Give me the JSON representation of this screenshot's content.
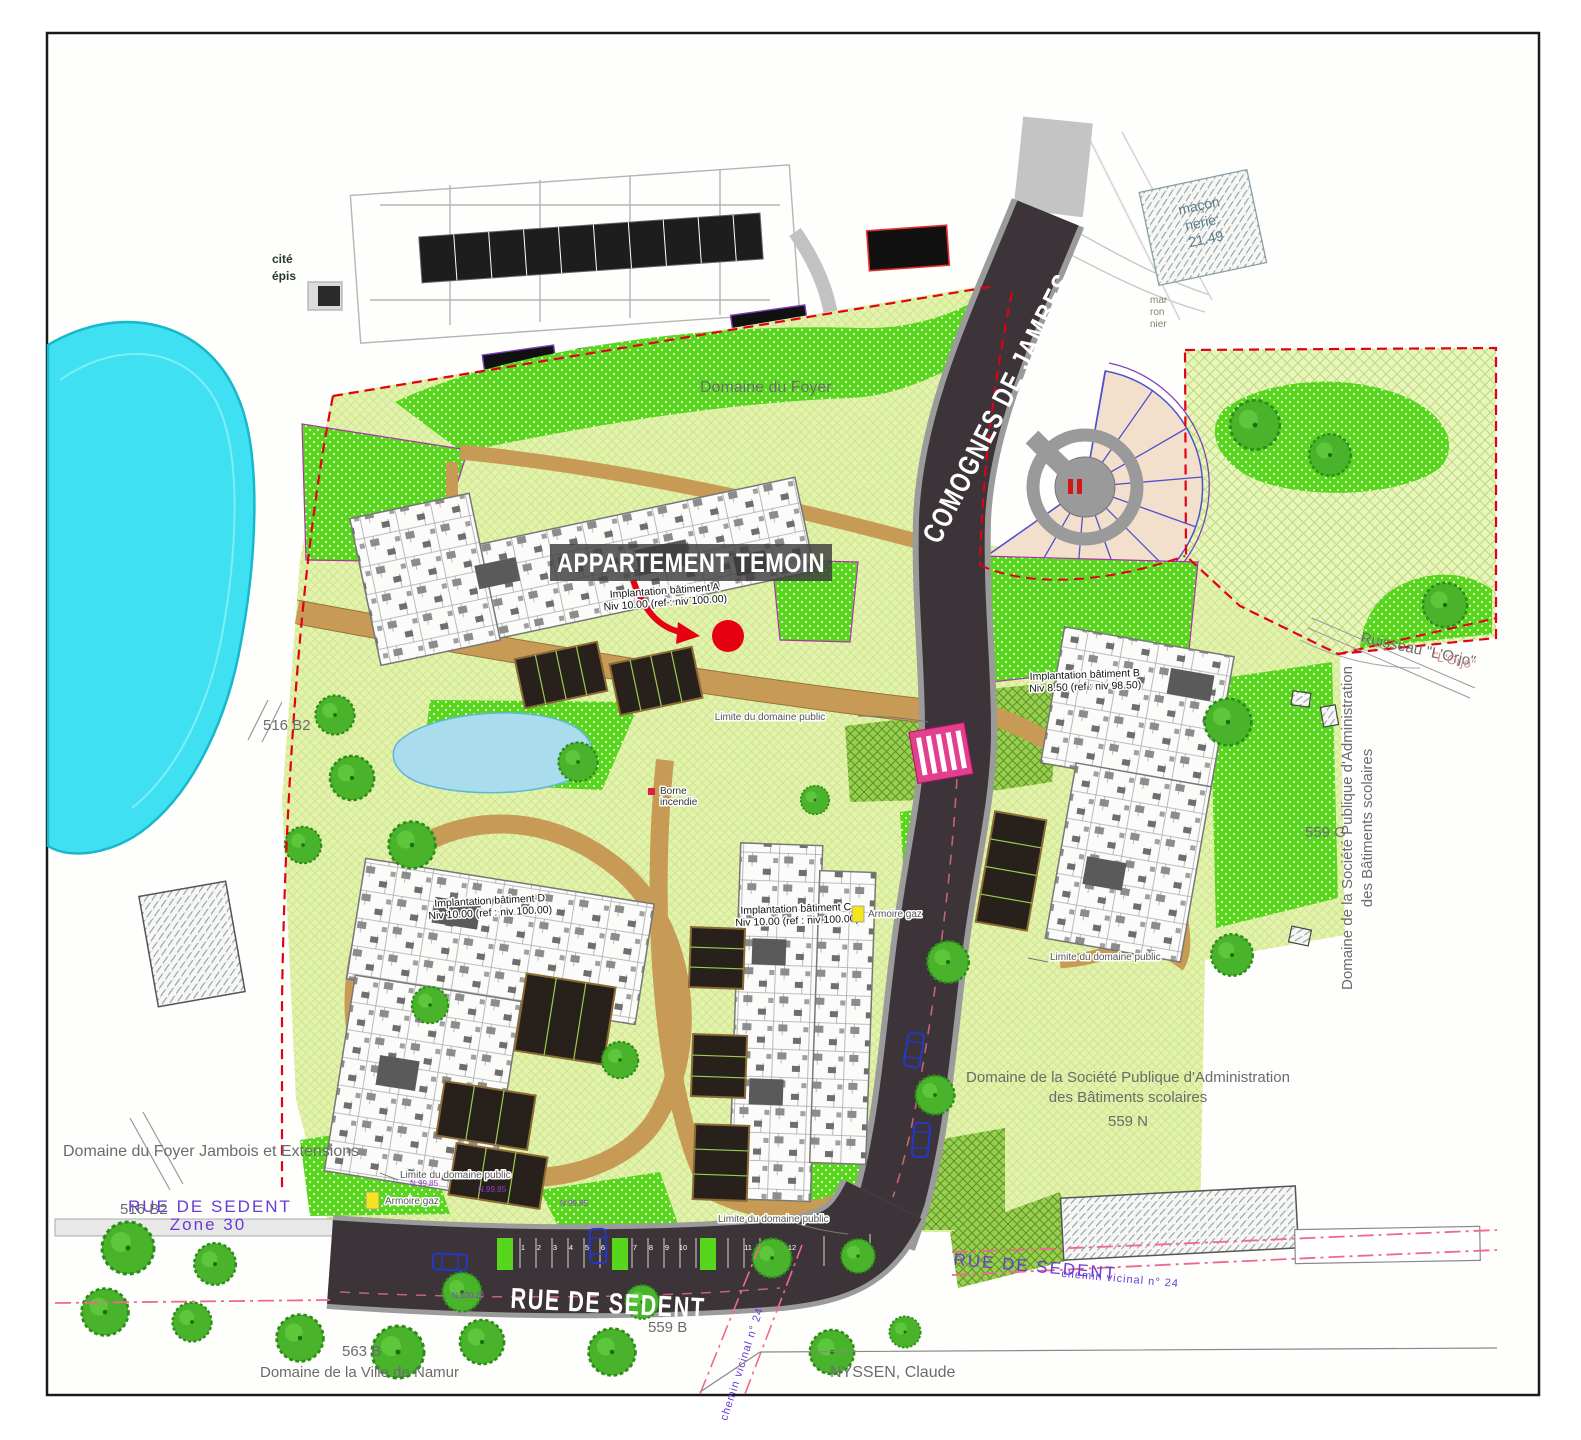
{
  "plan": {
    "callout": {
      "label": "APPARTEMENT TEMOIN"
    },
    "streets": {
      "comognes": "COMOGNES DE JAMBES",
      "rue_de_sedent": "RUE DE SEDENT",
      "rue_de_sedent_left": "RUE DE SEDENT",
      "zone": "Zone 30",
      "rue_de_sedent_right": "RUE DE SEDENT",
      "chemin_vicinal": "chemin vicinal n° 24",
      "chemin_vicinal_diag": "chemin vicinal n° 24"
    },
    "buildings": {
      "a_line1": "Implantation bâtiment A",
      "a_line2": "Niv 10.00 (ref : niv 100.00)",
      "b_line1": "Implantation bâtiment B",
      "b_line2": "Niv 8.50 (ref : niv 98.50)",
      "c_line1": "Implantation bâtiment C",
      "c_line2": "Niv 10.00 (ref : niv 100.00)",
      "d_line1": "Implantation bâtiment D",
      "d_line2": "Niv 10.00 (ref : niv 100.00)"
    },
    "parcels": {
      "left_516b2": "516 B2",
      "bottom_516b2": "516 B2",
      "g559": "559 G",
      "n559": "559 N",
      "b563": "563 B",
      "b559": "559 B"
    },
    "domains": {
      "foyer_top": "Domaine du Foyer",
      "foyer_left": "Domaine du Foyer Jambois et Extensions",
      "ville_namur": "Domaine de la Ville de Namur",
      "societe_line1": "Domaine de la Société Publique d'Administration",
      "societe_line2": "des Bâtiments scolaires",
      "nyssen": "NYSSEN, Claude"
    },
    "water": {
      "ruisseau": "Ruisseau \"L'Orjo\"",
      "ruisseau_ghost": "\"L'Orjo\""
    },
    "notes": {
      "limite": "Limite du domaine public",
      "borne_line1": "Borne",
      "borne_line2": "incendie",
      "armoire": "Armoire gaz",
      "maconnerie_line1": "maçon",
      "maconnerie_line2": "nerie:",
      "maconnerie_line3": "21.49",
      "cite_line1": "cité",
      "cite_line2": "épis",
      "marronnier_line1": "mar",
      "marronnier_line2": "ron",
      "marronnier_line3": "nier"
    },
    "levels": {
      "l1": "N.99.85",
      "l2": "N.99.85",
      "l3": "N.99.85",
      "l4": "N.100.20"
    },
    "parking_numbers": [
      "1",
      "2",
      "3",
      "4",
      "5",
      "6",
      "7",
      "8",
      "9",
      "10",
      "11",
      "12"
    ],
    "colors": {
      "pond": "#3fe0f2",
      "site_green": "#e3f2ae",
      "bright_green": "#57d61b",
      "path_brown": "#c79a56",
      "road_dark": "#3d3439",
      "boundary_red": "#e30016",
      "crossing_pink": "#e23f8f",
      "highlight_red": "#e60012",
      "street_text_purple": "#6a3ad6"
    }
  }
}
